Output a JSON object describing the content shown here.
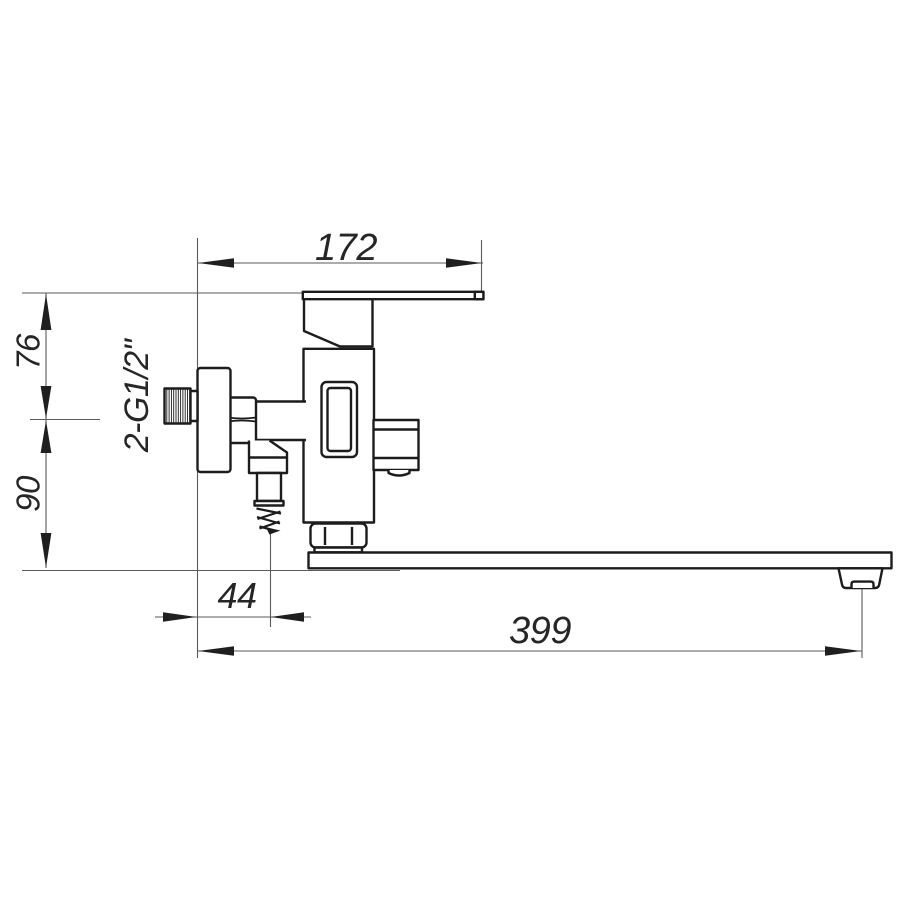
{
  "drawing": {
    "kind": "technical-dimension-drawing",
    "subject": "wall-mounted bath mixer faucet, side view",
    "labels": {
      "width_top": "172",
      "height_upper": "76",
      "height_lower": "90",
      "thread_spec": "2-G1/2\"",
      "offset_bottom": "44",
      "length_spout": "399"
    },
    "colors": {
      "background": "#ffffff",
      "object_line": "#1c1c1c",
      "dimension_line": "#5a5a5a",
      "label_text": "#262626"
    }
  }
}
